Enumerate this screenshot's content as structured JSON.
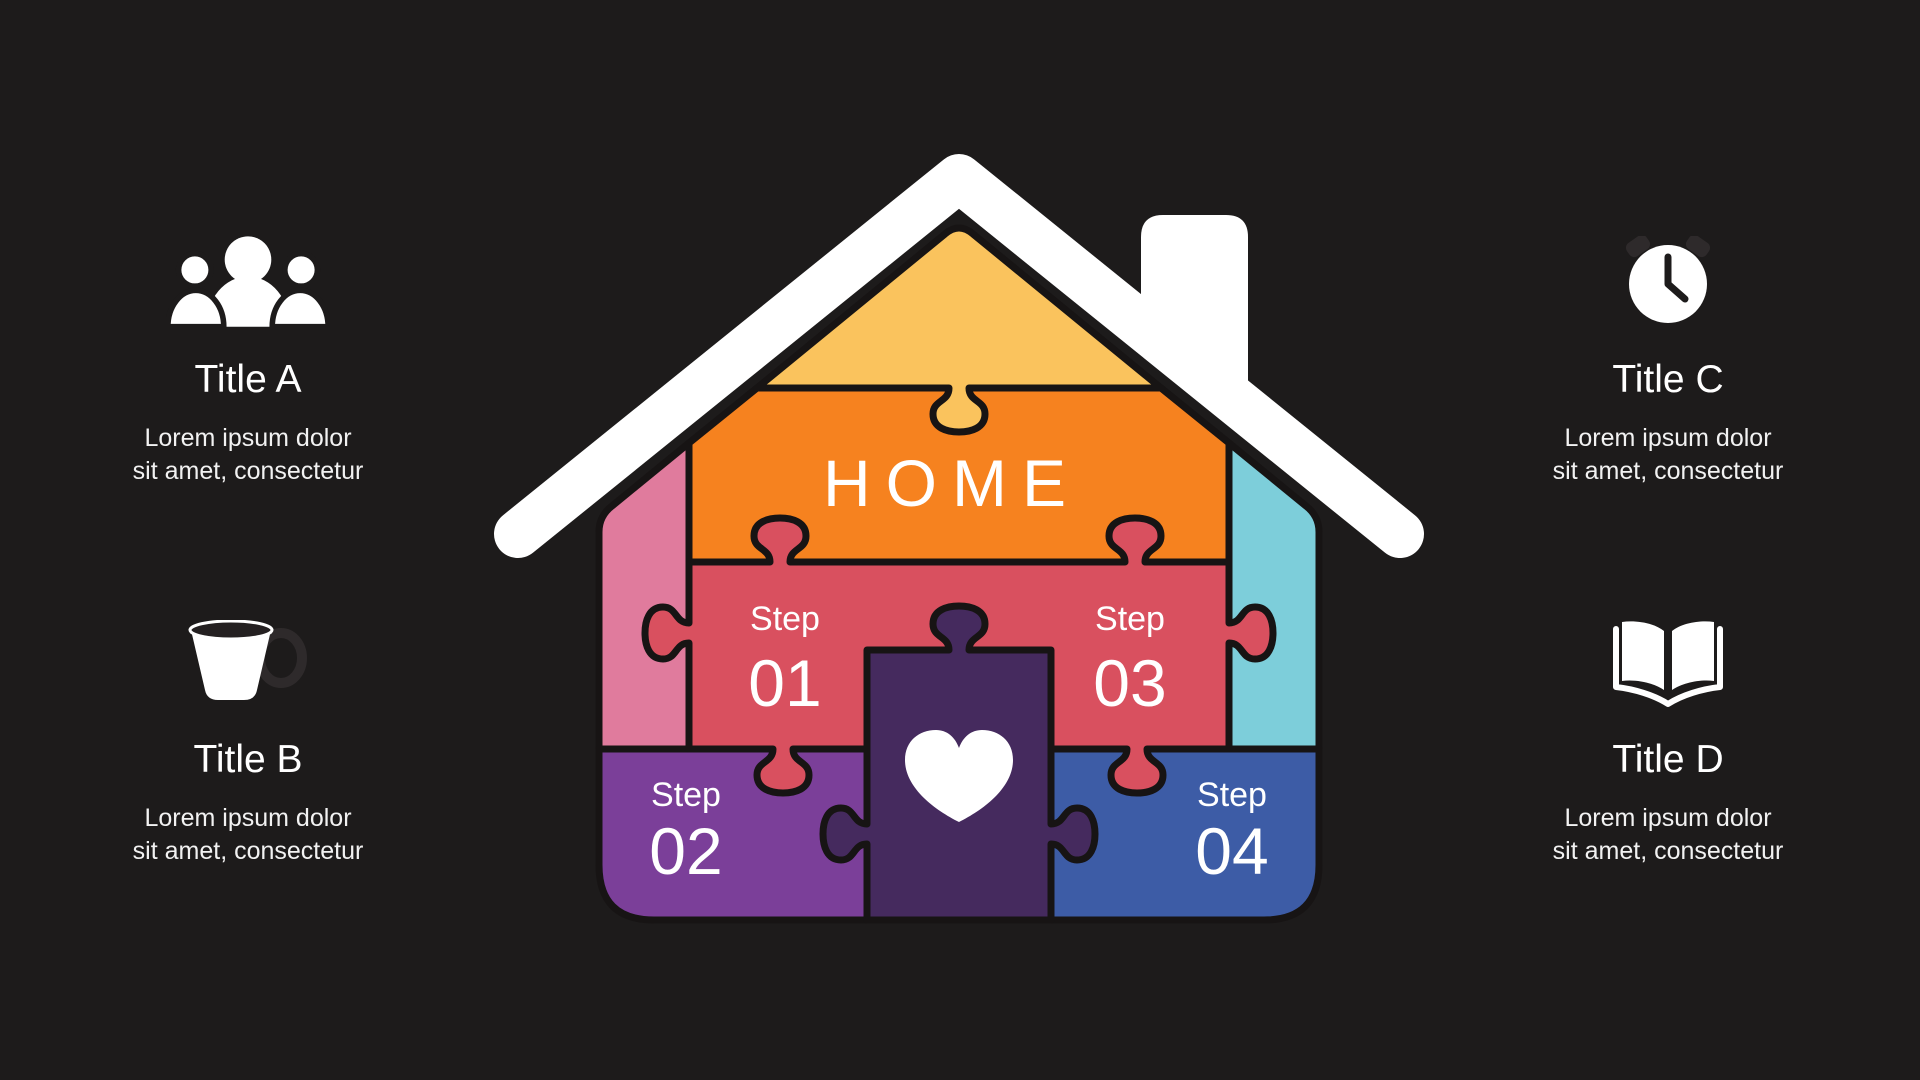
{
  "slide": {
    "background_color": "#1D1B1B",
    "house": {
      "label": "HOME",
      "colors": {
        "roof": "#FFFFFF",
        "chimney": "#FFFFFF",
        "gable": "#FAC35D",
        "banner": "#F6821F",
        "mid_band": "#D9505F",
        "left_wall": "#E07B9D",
        "right_wall": "#7DCEDA",
        "step2_piece": "#7B3F99",
        "step4_piece": "#3D5CA6",
        "center_piece": "#452A5E",
        "outline": "#171414",
        "heart": "#FFFFFF"
      },
      "heart_icon": "heart-icon",
      "steps": [
        {
          "label": "Step",
          "number": "01"
        },
        {
          "label": "Step",
          "number": "02"
        },
        {
          "label": "Step",
          "number": "03"
        },
        {
          "label": "Step",
          "number": "04"
        }
      ]
    },
    "info_blocks": [
      {
        "icon": "people-icon",
        "title": "Title A",
        "line1": "Lorem ipsum dolor",
        "line2": "sit amet, consectetur"
      },
      {
        "icon": "cup-icon",
        "title": "Title B",
        "line1": "Lorem ipsum dolor",
        "line2": "sit amet, consectetur"
      },
      {
        "icon": "clock-icon",
        "title": "Title C",
        "line1": "Lorem ipsum dolor",
        "line2": "sit amet, consectetur"
      },
      {
        "icon": "book-icon",
        "title": "Title D",
        "line1": "Lorem ipsum dolor",
        "line2": "sit amet, consectetur"
      }
    ]
  }
}
